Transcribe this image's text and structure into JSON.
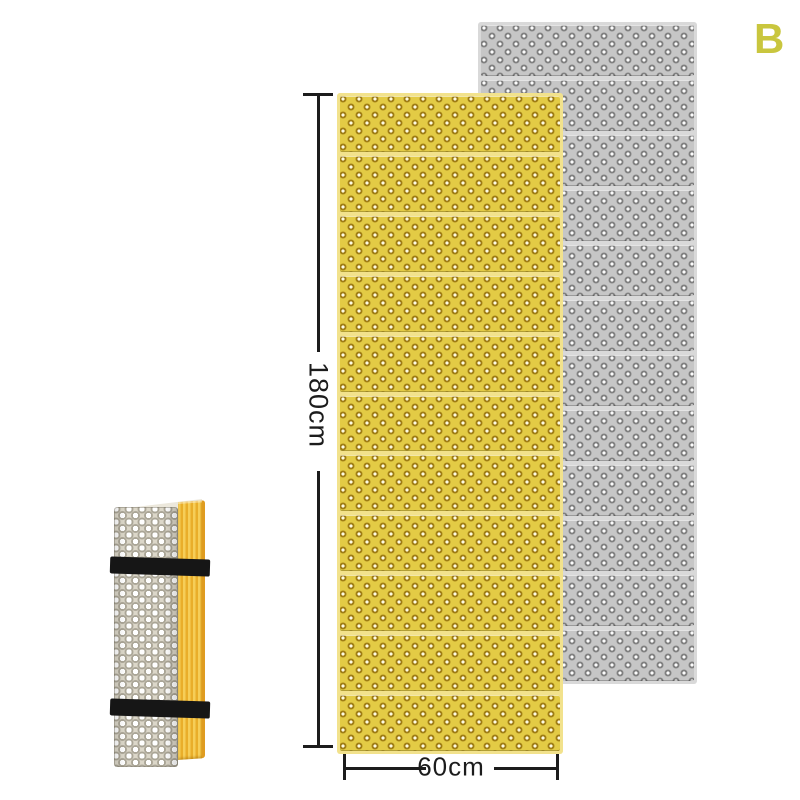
{
  "page": {
    "background": "#ffffff",
    "variant_label": "B",
    "variant_color": "#c9c63e"
  },
  "dimensions": {
    "height_label": "180cm",
    "width_label": "60cm",
    "line_color": "#1c1c1c",
    "text_color": "#1c1c1c"
  },
  "mats": {
    "yellow": {
      "label": "unfolded accordion mat, yellow",
      "segments": 11,
      "base_color": "#e3cb45",
      "dot_ring_color": "#9e7c14",
      "dot_center_color": "#fffbe2",
      "fold_band_color": "#f2e28c"
    },
    "gray": {
      "label": "unfolded accordion mat, gray",
      "segments": 12,
      "base_color": "#c6c6c6",
      "dot_ring_color": "#7f7f7f",
      "dot_center_color": "#fdfdfd",
      "fold_band_color": "#d9d9d9"
    },
    "folded": {
      "label": "folded mat bundle with straps",
      "face_color": "#dcd7c9",
      "bump_color": "#ffffff",
      "bump_ring_color": "#aaa596",
      "side_stripe_light": "#f6ce58",
      "side_stripe_dark": "#e9ae2a",
      "side_edge_color": "#df9c20",
      "top_color": "#ece8dc",
      "strap_color": "#161616",
      "strap_count": 2
    }
  }
}
